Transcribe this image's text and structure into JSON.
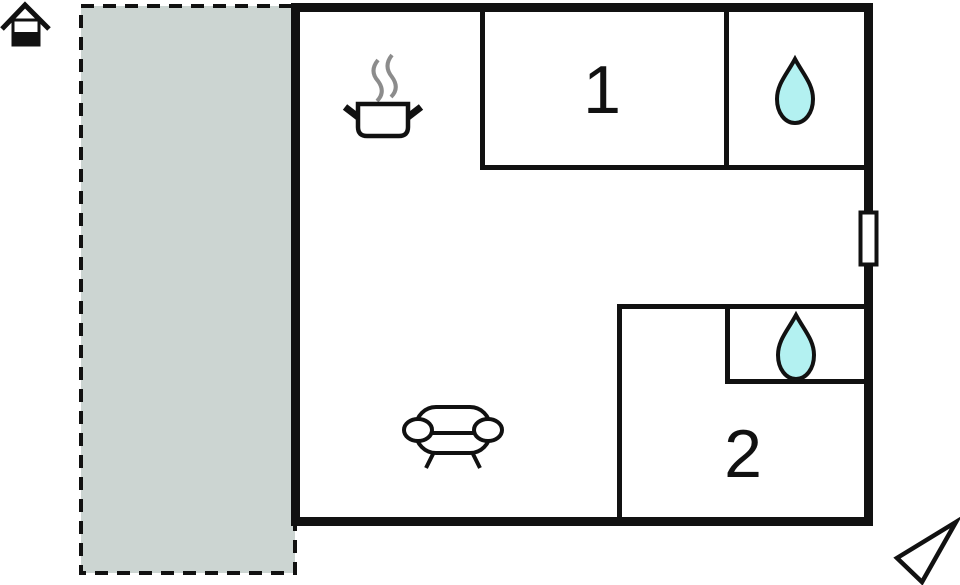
{
  "plan": {
    "title": "holiday-home-floor-plan",
    "rooms": [
      {
        "label": "1"
      },
      {
        "label": "2"
      }
    ],
    "icons": {
      "house": "house-icon",
      "kitchen": "cooking-pot-icon",
      "bathroom_1": "water-drop-icon",
      "bathroom_2": "water-drop-icon",
      "living_room": "sofa-icon",
      "window": "window-marker",
      "compass": "north-arrow-icon"
    },
    "colors": {
      "terrace_fill": "#ccd5d2",
      "water_fill": "#b3f1f1",
      "wall": "#111111",
      "steam_gray": "#8c8c8c",
      "background": "#ffffff"
    }
  }
}
